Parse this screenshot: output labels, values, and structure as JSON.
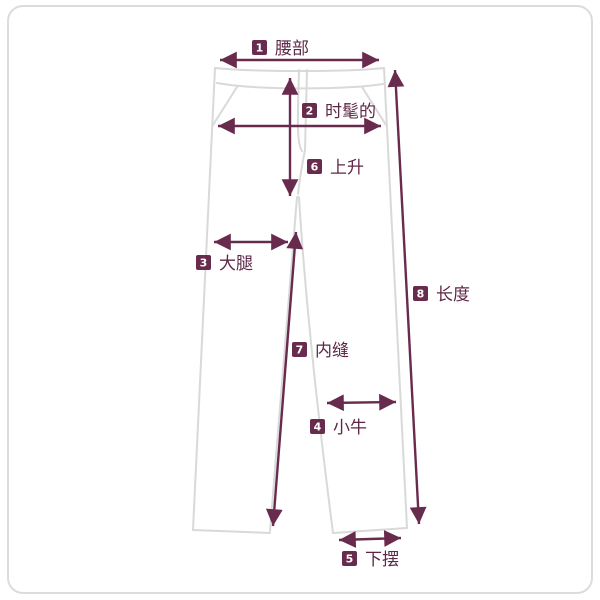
{
  "diagram": {
    "kind": "pants-size-measurement-diagram",
    "colors": {
      "background": "#ffffff",
      "border": "#dcdcdc",
      "garment_outline": "#d9d9d9",
      "measure_line": "#692b4d",
      "badge_bg": "#692b4d",
      "badge_number": "#ffffff",
      "label_text": "#5e2746"
    },
    "labels": {
      "waist": {
        "num": "1",
        "text": "腰部"
      },
      "hip": {
        "num": "2",
        "text": "时髦的"
      },
      "thigh": {
        "num": "3",
        "text": "大腿"
      },
      "calf": {
        "num": "4",
        "text": "小牛"
      },
      "hem": {
        "num": "5",
        "text": "下摆"
      },
      "rise": {
        "num": "6",
        "text": "上升"
      },
      "inseam": {
        "num": "7",
        "text": "内缝"
      },
      "length": {
        "num": "8",
        "text": "长度"
      }
    }
  }
}
